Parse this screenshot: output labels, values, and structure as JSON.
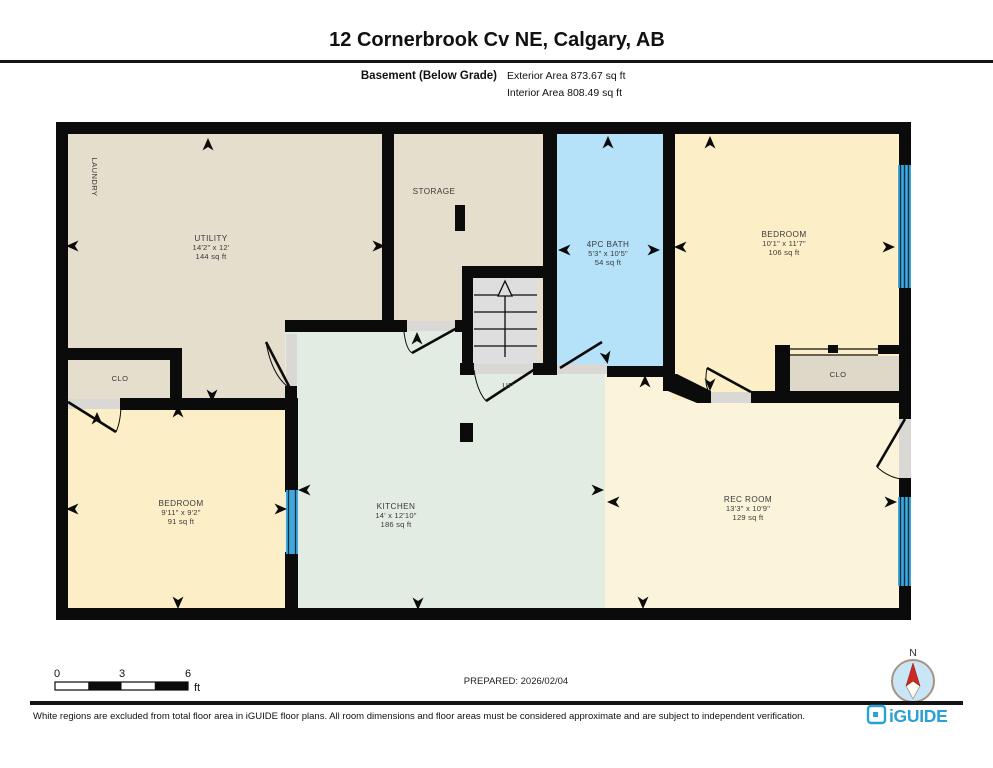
{
  "header": {
    "title": "12 Cornerbrook Cv NE, Calgary, AB",
    "floor_label": "Basement (Below Grade)",
    "exterior_area": "Exterior Area 873.67 sq ft",
    "interior_area": "Interior Area 808.49 sq ft"
  },
  "rooms": {
    "laundry": {
      "name": "LAUNDRY"
    },
    "utility": {
      "name": "UTILITY",
      "dims": "14'2\" x 12'",
      "area": "144 sq ft"
    },
    "storage": {
      "name": "STORAGE"
    },
    "stairs": {
      "label": "UP"
    },
    "bath": {
      "name": "4PC BATH",
      "dims": "5'3\" x 10'5\"",
      "area": "54 sq ft"
    },
    "bedroom_right": {
      "name": "BEDROOM",
      "dims": "10'1\" x 11'7\"",
      "area": "106 sq ft"
    },
    "closet_right": {
      "name": "CLO"
    },
    "closet_left": {
      "name": "CLO"
    },
    "bedroom_left": {
      "name": "BEDROOM",
      "dims": "9'11\" x 9'2\"",
      "area": "91 sq ft"
    },
    "kitchen": {
      "name": "KITCHEN",
      "dims": "14' x 12'10\"",
      "area": "186 sq ft"
    },
    "rec_room": {
      "name": "REC ROOM",
      "dims": "13'3\" x 10'9\"",
      "area": "129 sq ft"
    }
  },
  "scale_bar": {
    "tick_0": "0",
    "tick_3": "3",
    "tick_6": "6",
    "unit": "ft"
  },
  "prepared": {
    "label": "PREPARED: 2026/02/04"
  },
  "compass": {
    "north_label": "N"
  },
  "footer": {
    "disclaimer": "White regions are excluded from total floor area in iGUIDE floor plans. All room dimensions and floor areas must be considered approximate and are subject to independent verification.",
    "brand": "iGUIDE"
  },
  "colors": {
    "wall": "#0b0b0b",
    "utility_beige": "#e5decd",
    "bath_blue": "#b5e2f8",
    "bedroom_yellow": "#fcefc8",
    "kitchen_green": "#e2ece3",
    "rec_room_cream": "#fbf4da",
    "closet_gray": "#ded8c9",
    "window_blue": "#3fa9dc",
    "brand_blue": "#2aa0d5",
    "compass_red": "#cc2a20",
    "compass_blue": "#c8e6f6"
  }
}
